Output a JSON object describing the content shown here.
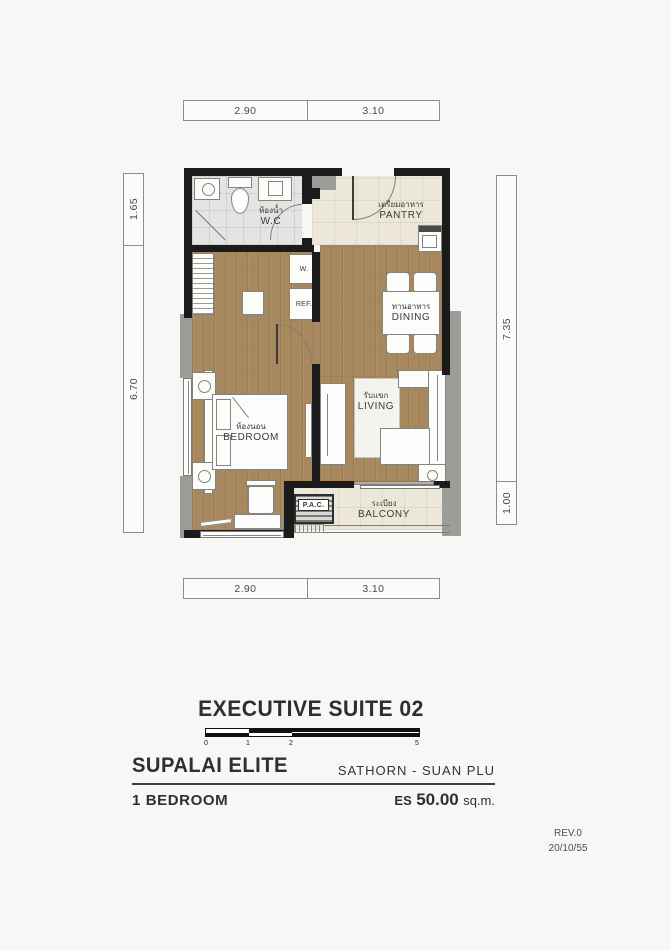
{
  "plan": {
    "dims": {
      "top": [
        "2.90",
        "3.10"
      ],
      "bottom": [
        "2.90",
        "3.10"
      ],
      "left": [
        "1.65",
        "6.70"
      ],
      "right": [
        "7.35",
        "1.00"
      ]
    },
    "rooms": {
      "wc": {
        "thai": "ห้องน้ำ",
        "en": "W.C"
      },
      "pantry": {
        "thai": "เตรียมอาหาร",
        "en": "PANTRY"
      },
      "dining": {
        "thai": "ทานอาหาร",
        "en": "DINING"
      },
      "living": {
        "thai": "รับแขก",
        "en": "LIVING"
      },
      "bedroom": {
        "thai": "ห้องนอน",
        "en": "BEDROOM"
      },
      "balcony": {
        "thai": "ระเบียง",
        "en": "BALCONY"
      }
    },
    "labels": {
      "washer": "W.",
      "fridge": "REF.",
      "ac_unit": "P.A.C."
    }
  },
  "titleblock": {
    "unit_title": "EXECUTIVE SUITE 02",
    "scale_ticks": [
      "0",
      "1",
      "2",
      "5"
    ],
    "brand": "SUPALAI ELITE",
    "location": "SATHORN - SUAN PLU",
    "unit_type": "1 BEDROOM",
    "area_prefix": "ES",
    "area_value": "50.00",
    "area_unit": "sq.m.",
    "revision": "REV.0",
    "revision_date": "20/10/55"
  },
  "colors": {
    "wall": "#1b1b1b",
    "wood_floor": "#a8895f",
    "tile_cream": "#ece7d8",
    "tile_gray": "#e4e4e2",
    "accent_gray": "#9c9c98"
  }
}
